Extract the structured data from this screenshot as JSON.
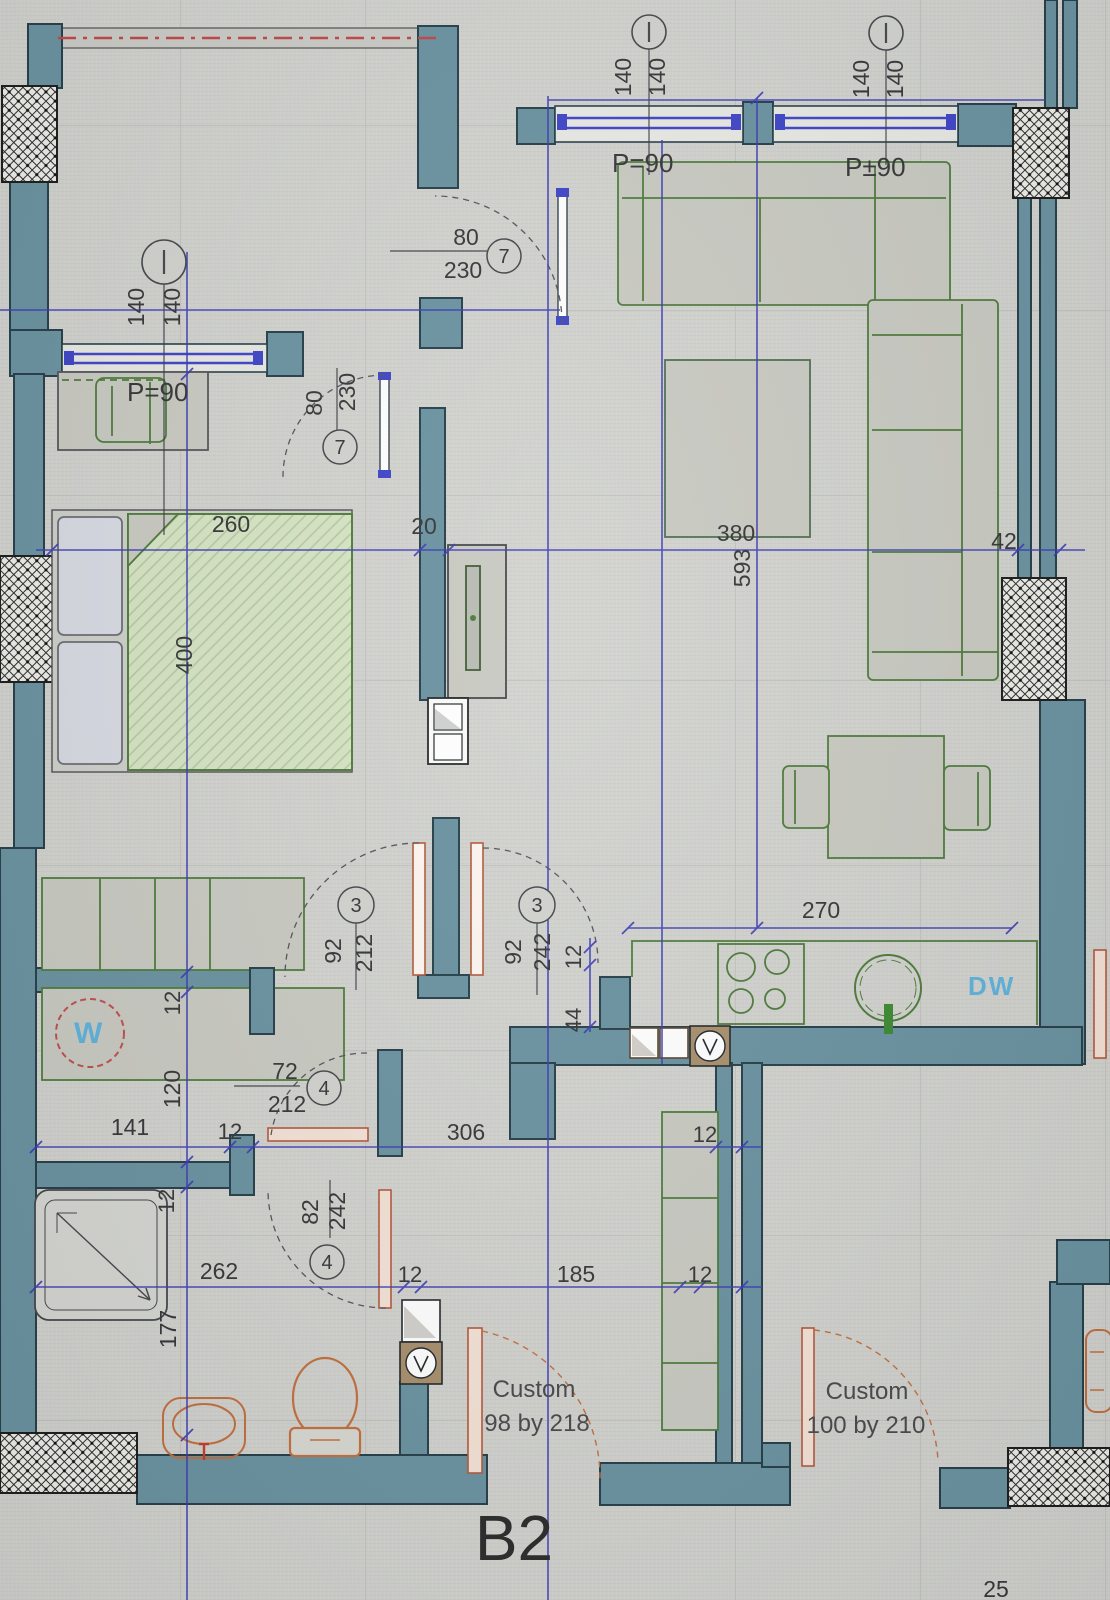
{
  "plan": {
    "unit_label": "B2",
    "corner_dim": "25",
    "appliances": {
      "dishwasher": "DW",
      "washer": "W"
    },
    "colors": {
      "wall": "#6b93a1",
      "wall_stroke": "#27404a",
      "axis_blue": "#3c3cb6",
      "window_blue": "#3f46c8",
      "furniture_green": "#4e7c3c",
      "fixture_orange": "#c4703f",
      "label_blue": "#5fb3dc",
      "dash_red": "#c04848"
    },
    "windows": [
      {
        "id": "bedroom-left",
        "dim_a": "140",
        "dim_b": "140",
        "parapet": "P=90"
      },
      {
        "id": "living-first",
        "dim_a": "140",
        "dim_b": "140",
        "parapet": "P=90"
      },
      {
        "id": "living-second",
        "dim_a": "140",
        "dim_b": "140",
        "parapet": "P±90"
      }
    ],
    "doors": [
      {
        "tag": "7",
        "width": "80",
        "height": "230"
      },
      {
        "tag": "7",
        "width": "80",
        "height": "230"
      },
      {
        "tag": "3",
        "width": "92",
        "height": "212"
      },
      {
        "tag": "3",
        "width": "92",
        "height": "242"
      },
      {
        "tag": "4",
        "width": "72",
        "height": "212"
      },
      {
        "tag": "4",
        "width": "82",
        "height": "242"
      },
      {
        "label_line1": "Custom",
        "label_line2": "98 by 218"
      },
      {
        "label_line1": "Custom",
        "label_line2": "100 by 210"
      }
    ],
    "dims": {
      "bedroom_width": "260",
      "entry_wall": "20",
      "living_width": "380",
      "right_wall": "42",
      "bedroom_depth": "400",
      "living_depth": "593",
      "kitchen_run": "270",
      "kitchen_gap": "12",
      "kitchen_offset": "44",
      "utility_width": "141",
      "utility_wall": "12",
      "hall_width": "306",
      "closet_wall_top": "12",
      "shower_run": "262",
      "bath_wall_a": "12",
      "hall_lower": "185",
      "closet_wall_bottom": "12",
      "washer_wall": "12",
      "utility_depth": "120",
      "bath_wall_b": "12",
      "bath_depth": "177"
    }
  }
}
